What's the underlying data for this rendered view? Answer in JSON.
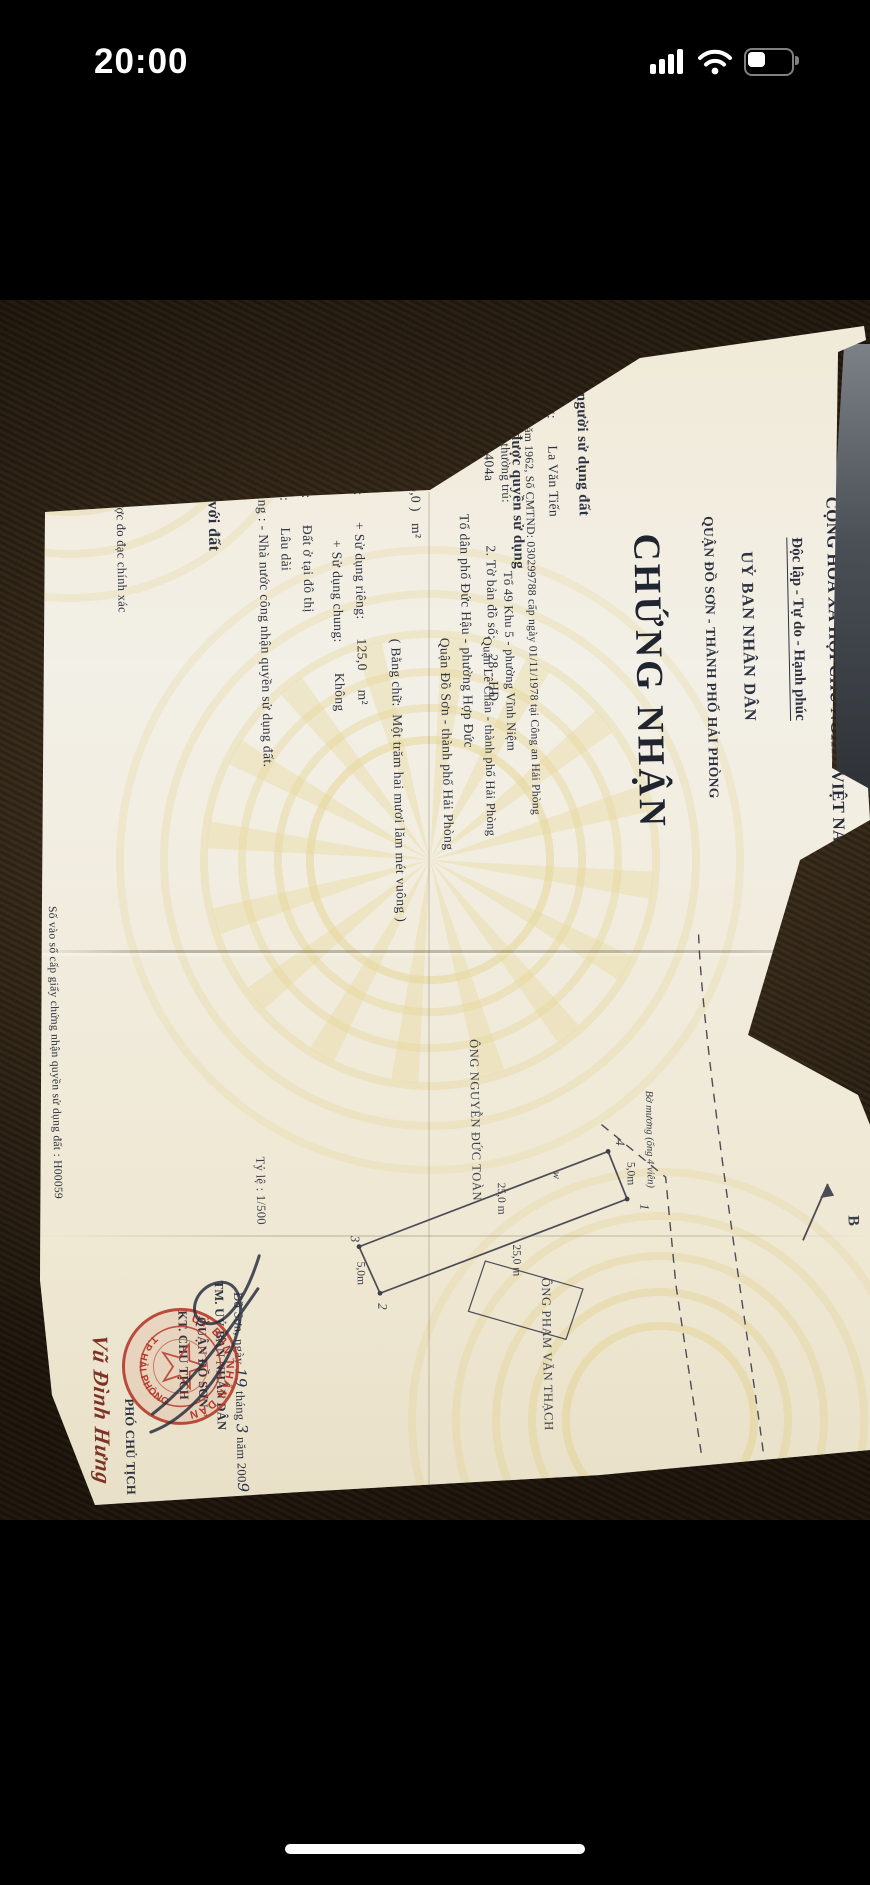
{
  "status_bar": {
    "time": "20:00",
    "icons": [
      "signal-bars",
      "wifi",
      "battery"
    ],
    "battery_fill_ratio": "0.38"
  },
  "certificate": {
    "national_header": {
      "line1": "CỘNG HÒA XÃ HỘI CHỦ NGHĨA VIỆT NAM",
      "line2": "Độc lập - Tự do - Hạnh phúc"
    },
    "issuer": {
      "line1": "UỶ BAN NHÂN DÂN",
      "line2": "QUẬN ĐỒ SƠN - THÀNH PHỐ HẢI PHÒNG"
    },
    "title": "CHỨNG NHẬN",
    "section_1": {
      "heading": "I- Tên người sử dụng đất",
      "owner_line": "Ông:       La Văn Tiến",
      "birth_id_line": "Sinh năm 1962, Số CMTND: 030299788 cấp ngày 01/11/1978 tại Công an Hải Phòng",
      "address_line1": "Địa chỉ thường trú:                    Tổ 49 Khu 5 - phường Vĩnh Niệm",
      "address_line2": "Quận Lê Chân - thành phố Hải Phòng"
    },
    "section_2": {
      "heading": "II- Thửa đất được quyền sử dụng",
      "item1_2": "1. Thửa đất số:    404a                 2. Tờ bản đồ số:    28 - HĐ",
      "item3": "3. Địa chỉ thửa đất:            Tổ dân phố Đức Hậu - phường Hợp Đức",
      "item3b": "Quận Đồ Sơn - thành phố Hải Phòng",
      "item4": "4. Diện tích:       ( 125,0 )   m²",
      "item4_words": "( Bằng chữ:  Một trăm hai mươi lăm mét vuông )",
      "item5": "5. Hình thức sử dụng:       + Sử dụng riêng:     125,0     m²",
      "item5b": "+ Sử dụng chung:        Không",
      "item6": "6. Mục đích sử dụng:       Đất ở tại đô thị",
      "item7": "7. Thời hạn sử dụng:       Lâu dài",
      "item8": "8. Nguồn gốc sử dụng : - Nhà nước công nhận quyền sử dụng đất."
    },
    "section_3": {
      "heading": "III- Tài sản gắn liền với đất"
    },
    "section_4": {
      "heading": "IV- Ghi chú",
      "note1": "1- Diện tích chưa được đo đạc chính xác"
    },
    "section_5": {
      "heading": "V- Sơ đồ thửa đất",
      "plot": {
        "corner_1": "1",
        "corner_2": "2",
        "corner_3": "3",
        "corner_4": "4",
        "side_long": "25,0 m",
        "side_short": "5,0m",
        "neighbor_top": "ÔNG NGUYỄN ĐỨC TOÀN",
        "neighbor_bottom": "ÔNG PHẠM VĂN THẠCH",
        "canal_label": "Bờ mương (ống 4 viên)",
        "scale": "Tỷ lệ : 1/500",
        "compass_north": "B",
        "surveyor_mark": "w"
      }
    },
    "registry_line": "Số vào sổ cấp giấy chứng nhận quyền sử dụng đất : H00059",
    "signing": {
      "date_p1": "Đồ Sơn, ngày ",
      "date_p2": "19",
      "date_p3": " tháng ",
      "date_p4": "3",
      "date_p5": " năm 200",
      "date_p6": "9",
      "authority_1": "TM. UỶ BAN NHÂN DÂN",
      "authority_2": "QUẬN ĐỒ SƠN",
      "authority_3": "KT. CHỦ TỊCH",
      "authority_4": "PHÓ CHỦ TỊCH",
      "signer_name": "Vũ Đình Hưng",
      "seal_arc_top": "UỶ BAN NHÂN DÂN",
      "seal_arc_bottom": "T.P HẢI PHÒNG"
    }
  },
  "colors": {
    "seal_red": "#b43a2c",
    "paper": "#f2efe6",
    "carpet_brown": "#33281b",
    "ink": "#2e3140",
    "guilloche_yellow": "#e5d492"
  }
}
